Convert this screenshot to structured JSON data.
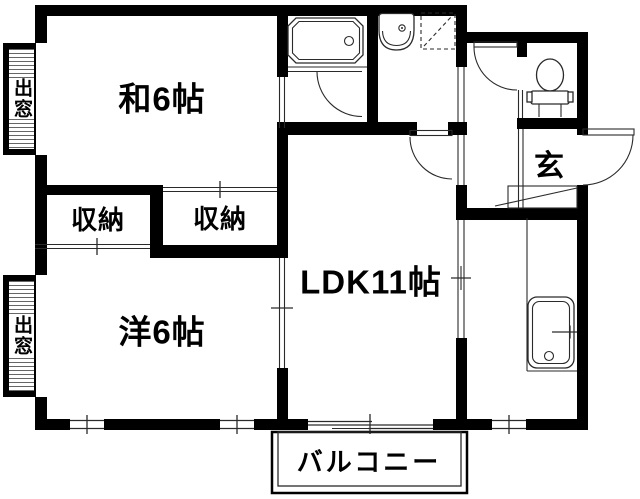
{
  "plan": {
    "type": "apartment-floor-plan",
    "labels": {
      "washitsu": "和6帖",
      "closet_left": "収納",
      "closet_right": "収納",
      "youshitsu": "洋6帖",
      "ldk": "LDK11帖",
      "genkan": "玄",
      "balcony": "バルコニー",
      "bay_window_top": "出窓",
      "bay_window_bottom": "出窓"
    },
    "colors": {
      "wall": "#000000",
      "background": "#ffffff",
      "line": "#2a2a2a"
    }
  }
}
